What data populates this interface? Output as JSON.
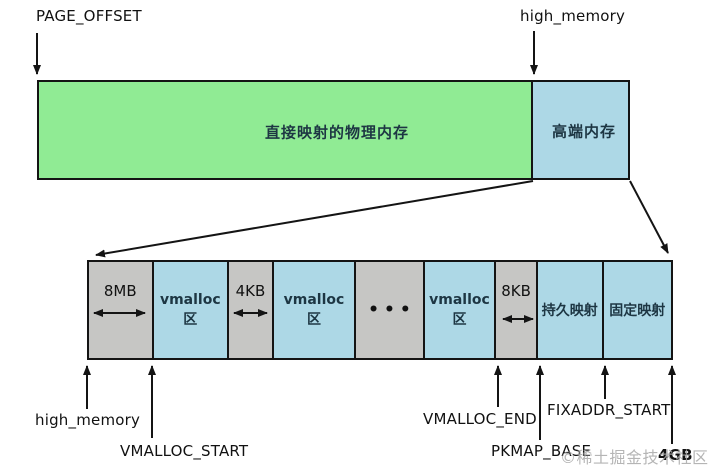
{
  "top_labels": {
    "page_offset": "PAGE_OFFSET",
    "high_memory": "high_memory"
  },
  "main_bar": {
    "direct_mapped_label": "直接映射的物理内存",
    "high_mem_label": "高端内存"
  },
  "expanded_bar": {
    "segments": [
      {
        "name": "gap-8mb",
        "label": "8MB",
        "type": "gap"
      },
      {
        "name": "vmalloc-area-1",
        "label": "vmalloc",
        "label2": "区",
        "type": "area"
      },
      {
        "name": "gap-4kb",
        "label": "4KB",
        "type": "gap"
      },
      {
        "name": "vmalloc-area-2",
        "label": "vmalloc",
        "label2": "区",
        "type": "area"
      },
      {
        "name": "ellipsis",
        "label": "•••",
        "type": "gap"
      },
      {
        "name": "vmalloc-area-3",
        "label": "vmalloc",
        "label2": "区",
        "type": "area"
      },
      {
        "name": "gap-8kb",
        "label": "8KB",
        "type": "gap"
      },
      {
        "name": "persistent-mapping",
        "label": "持久映射",
        "type": "area"
      },
      {
        "name": "fixed-mapping",
        "label": "固定映射",
        "type": "area"
      }
    ]
  },
  "pointers": {
    "high_memory": "high_memory",
    "vmalloc_start": "VMALLOC_START",
    "vmalloc_end": "VMALLOC_END",
    "pkmap_base": "PKMAP_BASE",
    "fixaddr_start": "FIXADDR_START",
    "four_gb": "4GB"
  },
  "watermark": {
    "logo": "©",
    "text": "稀土掘金技术社区"
  },
  "colors": {
    "direct_mapped_green": "#90eb94",
    "memory_blue": "#add8e6",
    "gap_gray": "#c6c6c4",
    "border_black": "#141414",
    "cjk_text": "#1d3643",
    "watermark_gray": "#a9a9a9"
  }
}
